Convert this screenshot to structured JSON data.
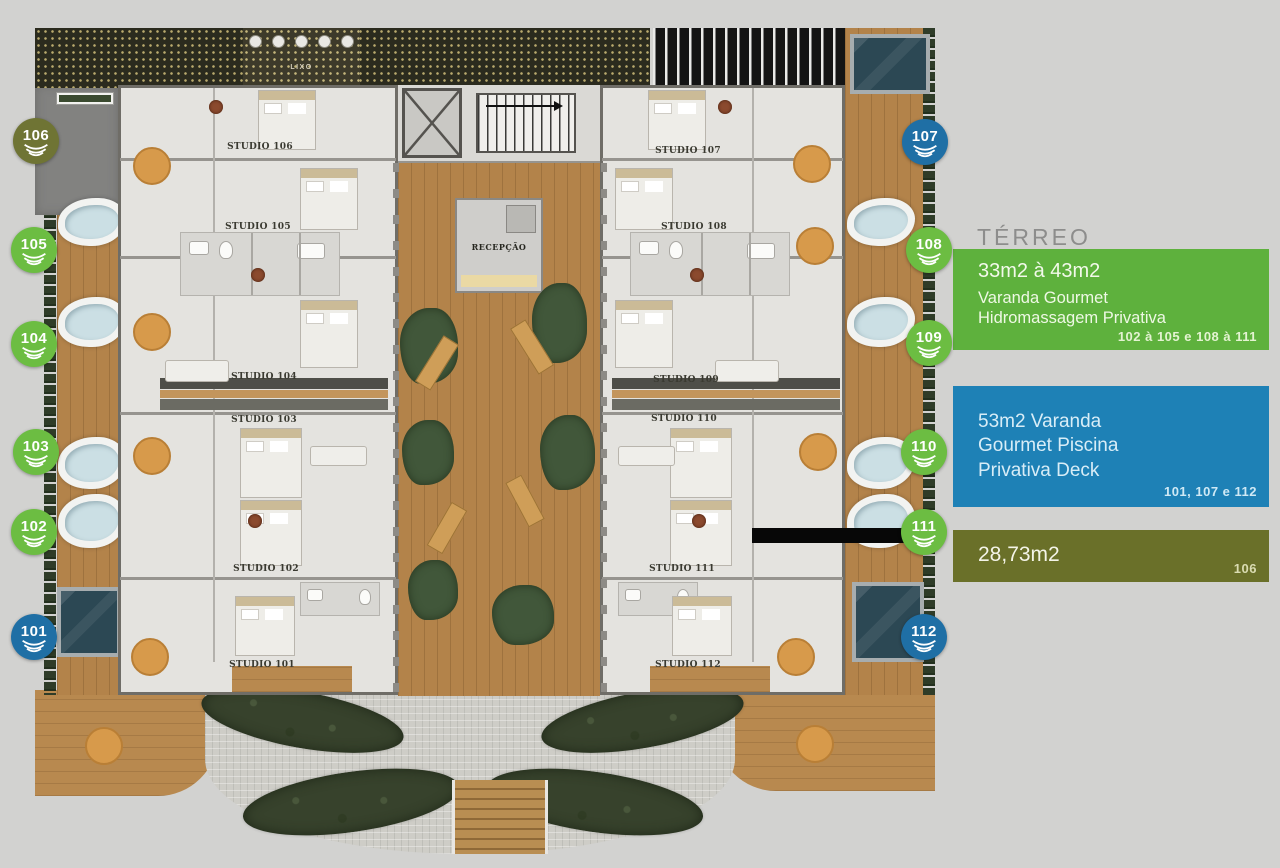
{
  "legend": {
    "title": "TÉRREO",
    "green": {
      "size": "33m2 à 43m2",
      "line1": "Varanda Gourmet",
      "line2": "Hidromassagem Privativa",
      "units": "102 à 105 e 108 à 111",
      "color": "#5eb13d"
    },
    "blue": {
      "line1": "53m2 Varanda",
      "line2": "Gourmet Piscina",
      "line3": "Privativa Deck",
      "units": "101, 107 e 112",
      "color": "#1e81b6"
    },
    "olive": {
      "size": "28,73m2",
      "units": "106",
      "color": "#6a7029"
    }
  },
  "badges": {
    "left": [
      {
        "label": "106",
        "type": "olive"
      },
      {
        "label": "105",
        "type": "green"
      },
      {
        "label": "104",
        "type": "green"
      },
      {
        "label": "103",
        "type": "green"
      },
      {
        "label": "102",
        "type": "green"
      },
      {
        "label": "101",
        "type": "blue"
      }
    ],
    "right": [
      {
        "label": "107",
        "type": "blue"
      },
      {
        "label": "108",
        "type": "green"
      },
      {
        "label": "109",
        "type": "green"
      },
      {
        "label": "110",
        "type": "green"
      },
      {
        "label": "111",
        "type": "green"
      },
      {
        "label": "112",
        "type": "blue"
      }
    ]
  },
  "plan": {
    "reception_label": "RECEPÇÃO",
    "trash_label": "LIXO",
    "studios_left": [
      {
        "label": "STUDIO 106"
      },
      {
        "label": "STUDIO 105"
      },
      {
        "label": "STUDIO 104"
      },
      {
        "label": "STUDIO 103"
      },
      {
        "label": "STUDIO 102"
      },
      {
        "label": "STUDIO 101"
      }
    ],
    "studios_right": [
      {
        "label": "STUDIO 107"
      },
      {
        "label": "STUDIO 108"
      },
      {
        "label": "STUDIO 109"
      },
      {
        "label": "STUDIO 110"
      },
      {
        "label": "STUDIO 111"
      },
      {
        "label": "STUDIO 112"
      }
    ]
  },
  "colors": {
    "page_background": "#d2d2d0",
    "badge_green": "#6cbd42",
    "badge_blue": "#1f6fa5",
    "badge_olive": "#6f7434",
    "courtyard_wood": "#b3834a",
    "pool_water": "#2c4854"
  }
}
